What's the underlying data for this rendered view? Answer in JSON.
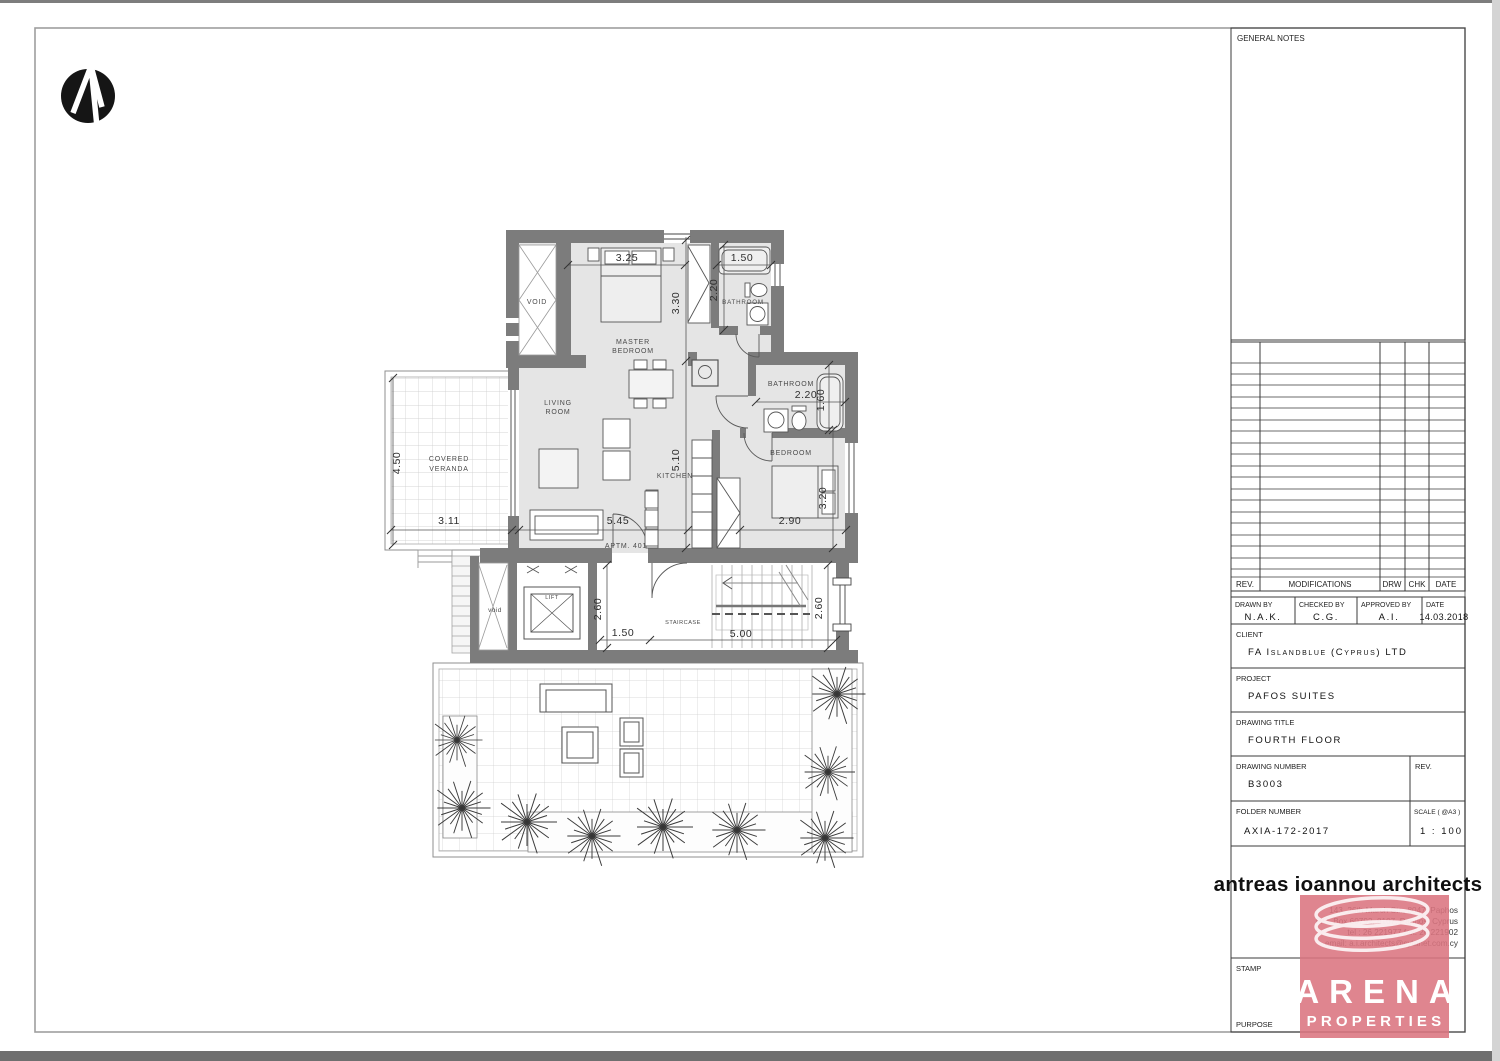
{
  "plan": {
    "apartment_label": "APTM. 401",
    "north_arrow": "north-arrow",
    "rooms": {
      "void_top": "VOID",
      "master_l1": "MASTER",
      "master_l2": "BEDROOM",
      "bathroom_top": "BATHROOM",
      "living_l1": "LIVING",
      "living_l2": "ROOM",
      "kitchen": "KITCHEN",
      "bathroom_mid": "BATHROOM",
      "bedroom": "BEDROOM",
      "veranda_l1": "COVERED",
      "veranda_l2": "VERANDA",
      "lift": "LIFT",
      "staircase": "STAIRCASE",
      "void_lower": "void"
    },
    "dims": {
      "master_w": "3.25",
      "bath_top_w": "1.50",
      "bath_top_h": "2.20",
      "master_h": "3.30",
      "living_h": "5.10",
      "living_w": "5.45",
      "veranda_h": "4.50",
      "veranda_w": "3.11",
      "bath_mid_w": "2.20",
      "bath_mid_h": "1.60",
      "bedroom_w": "2.90",
      "bedroom_h": "3.20",
      "hall_left_h": "2.60",
      "hall_w": "1.50",
      "stair_w": "5.00",
      "hall_right_h": "2.60"
    }
  },
  "titleblock": {
    "general_notes": "GENERAL NOTES",
    "revisions": {
      "rev": "REV.",
      "modifications": "MODIFICATIONS",
      "drw": "DRW",
      "chk": "CHK",
      "date": "DATE"
    },
    "signoff": {
      "drawn_label": "DRAWN BY",
      "drawn_value": "N.A.K.",
      "checked_label": "CHECKED BY",
      "checked_value": "C.G.",
      "approved_label": "APPROVED BY",
      "approved_value": "A.I.",
      "date_label": "DATE",
      "date_value": "14.03.2018"
    },
    "client": {
      "label": "CLIENT",
      "value": "FA Islandblue (Cyprus) LTD"
    },
    "project": {
      "label": "PROJECT",
      "value": "PAFOS SUITES"
    },
    "drawing_title": {
      "label": "DRAWING TITLE",
      "value": "FOURTH FLOOR"
    },
    "drawing_number": {
      "label": "DRAWING NUMBER",
      "value": "B3003"
    },
    "rev_label": "REV.",
    "folder_number": {
      "label": "FOLDER NUMBER",
      "value": "AXIA-172-2017"
    },
    "scale": {
      "label": "SCALE ( @A3 )",
      "value": "1 : 100"
    },
    "firm": {
      "name": "antreas ioannou architects",
      "address_line1": "143, 26th March Str., 8047, Paphos",
      "address_line2": "P.O. Box 60792, 8107, Paphos, Cyprus",
      "address_line3": "tel : 26 221977      fax: 26 221902",
      "address_line4": "email: a.i.architects@cytanet.com.cy"
    },
    "stamp_label": "STAMP",
    "purpose_label": "PURPOSE"
  },
  "watermark": {
    "line1": "ARENA",
    "line2": "PROPERTIES",
    "color": "#db7480"
  },
  "colors": {
    "wall": "#7c7c7c",
    "floor": "#e5e5e5"
  }
}
